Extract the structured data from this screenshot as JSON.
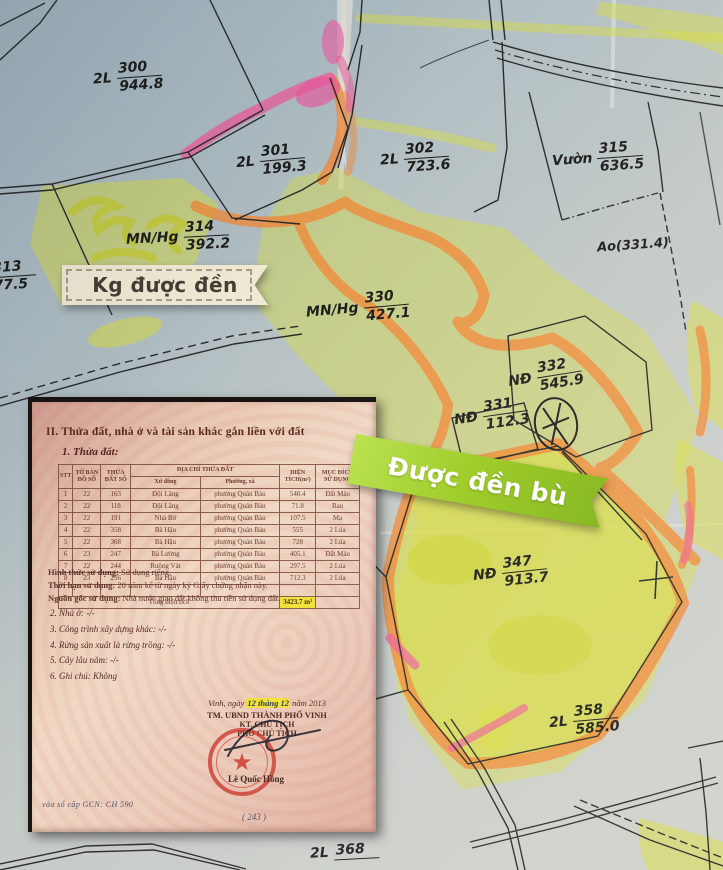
{
  "map": {
    "labels": [
      {
        "id": "300",
        "prefix": "2L",
        "num": "300",
        "den": "944.8"
      },
      {
        "id": "301",
        "prefix": "2L",
        "num": "301",
        "den": "199.3"
      },
      {
        "id": "302",
        "prefix": "2L",
        "num": "302",
        "den": "723.6"
      },
      {
        "id": "315",
        "prefix": "Vườn",
        "num": "315",
        "den": "636.5"
      },
      {
        "id": "314",
        "prefix": "MN/Hg",
        "num": "314",
        "den": "392.2"
      },
      {
        "id": "313",
        "prefix": "",
        "num": "313",
        "den": "77.5"
      },
      {
        "id": "330",
        "prefix": "MN/Hg",
        "num": "330",
        "den": "427.1"
      },
      {
        "id": "332",
        "prefix": "NĐ",
        "num": "332",
        "den": "545.9"
      },
      {
        "id": "331",
        "prefix": "NĐ",
        "num": "331",
        "den": "112.3"
      },
      {
        "id": "347",
        "prefix": "NĐ",
        "num": "347",
        "den": "913.7"
      },
      {
        "id": "358",
        "prefix": "2L",
        "num": "358",
        "den": "585.0"
      },
      {
        "id": "368",
        "prefix": "2L",
        "num": "368",
        "den": ""
      }
    ],
    "pond_label": "Ao(331.4)",
    "badges": {
      "not_compensated": "Kg được đền",
      "compensated": "Được đền bù"
    },
    "colors": {
      "paper_blue": "#aebdc4",
      "highlight_yellow": "#d9dd3f",
      "highlight_orange": "#f28a3a",
      "highlight_pink": "#ef5f9d",
      "badge_cream": "#f3ecd6",
      "badge_green": "#8cc41e",
      "stamp_red": "#c7231d",
      "total_highlight": "#f0e034"
    }
  },
  "document": {
    "section_title": "II. Thửa đất, nhà ở và tài sản khác gắn liền với đất",
    "subsection_title": "1. Thửa đất:",
    "table": {
      "headers": {
        "stt": "STT",
        "map_sheet": "TỜ BẢN ĐỒ SỐ",
        "parcel_no": "THỬA ĐẤT SỐ",
        "address": "ĐỊA CHỈ THỬA ĐẤT",
        "hamlet": "Xứ đồng",
        "ward": "Phường, xã",
        "area": "DIỆN TÍCH(m²)",
        "purpose": "MỤC ĐÍCH SỬ DỤNG"
      },
      "rows": [
        {
          "stt": "1",
          "sheet": "22",
          "parcel": "163",
          "hamlet": "Đội Lăng",
          "ward": "phường Quán Bàu",
          "area": "540.4",
          "purpose": "Đất Màu"
        },
        {
          "stt": "2",
          "sheet": "22",
          "parcel": "118",
          "hamlet": "Đội Lăng",
          "ward": "phường Quán Bàu",
          "area": "71.8",
          "purpose": "Rau"
        },
        {
          "stt": "3",
          "sheet": "22",
          "parcel": "191",
          "hamlet": "Nhà Bờ",
          "ward": "phường Quán Bàu",
          "area": "107.5",
          "purpose": "Mạ"
        },
        {
          "stt": "4",
          "sheet": "22",
          "parcel": "358",
          "hamlet": "Bà Hậu",
          "ward": "phường Quán Bàu",
          "area": "555",
          "purpose": "2 Lúa"
        },
        {
          "stt": "5",
          "sheet": "22",
          "parcel": "368",
          "hamlet": "Bà Hậu",
          "ward": "phường Quán Bàu",
          "area": "728",
          "purpose": "2 Lúa"
        },
        {
          "stt": "6",
          "sheet": "23",
          "parcel": "247",
          "hamlet": "Bà Lường",
          "ward": "phường Quán Bàu",
          "area": "405.1",
          "purpose": "Đất Màu"
        },
        {
          "stt": "7",
          "sheet": "22",
          "parcel": "244",
          "hamlet": "Ruộng Vát",
          "ward": "phường Quán Bàu",
          "area": "297.5",
          "purpose": "2 Lúa"
        },
        {
          "stt": "8",
          "sheet": "23",
          "parcel": "256",
          "hamlet": "Bà Hậu",
          "ward": "phường Quán Bàu",
          "area": "712.3",
          "purpose": "2 Lúa"
        }
      ],
      "total_label": "Tổng diện tích",
      "total_value": "3423.7 m²"
    },
    "usage_notes": [
      {
        "label": "Hình thức sử dụng:",
        "value": "Sử dụng riêng."
      },
      {
        "label": "Thời hạn sử dụng:",
        "value": "20 năm kể từ ngày ký Giấy chứng nhận này."
      },
      {
        "label": "Nguồn gốc sử dụng:",
        "value": "Nhà nước giao đất không thu tiền sử dụng đất."
      }
    ],
    "items": [
      "2. Nhà ở: -/-",
      "3. Công trình xây dựng khác: -/-",
      "4. Rừng sản xuất là rừng trồng: -/-",
      "5. Cây lâu năm: -/-",
      "6. Ghi chú: Không"
    ],
    "signature": {
      "place_date_prefix": "Vinh, ngày",
      "place_date_highlight": "12 tháng 12",
      "place_date_suffix": "năm 2013",
      "org": "TM. UBND THÀNH PHỐ VINH",
      "title1": "KT. CHỦ TỊCH",
      "title2": "PHÓ CHỦ TỊCH",
      "signer": "Lê Quốc Hồng",
      "handwritten_note": "vào sổ cấp GCN: CH 590",
      "handwritten_note2": "( 243 )"
    }
  }
}
